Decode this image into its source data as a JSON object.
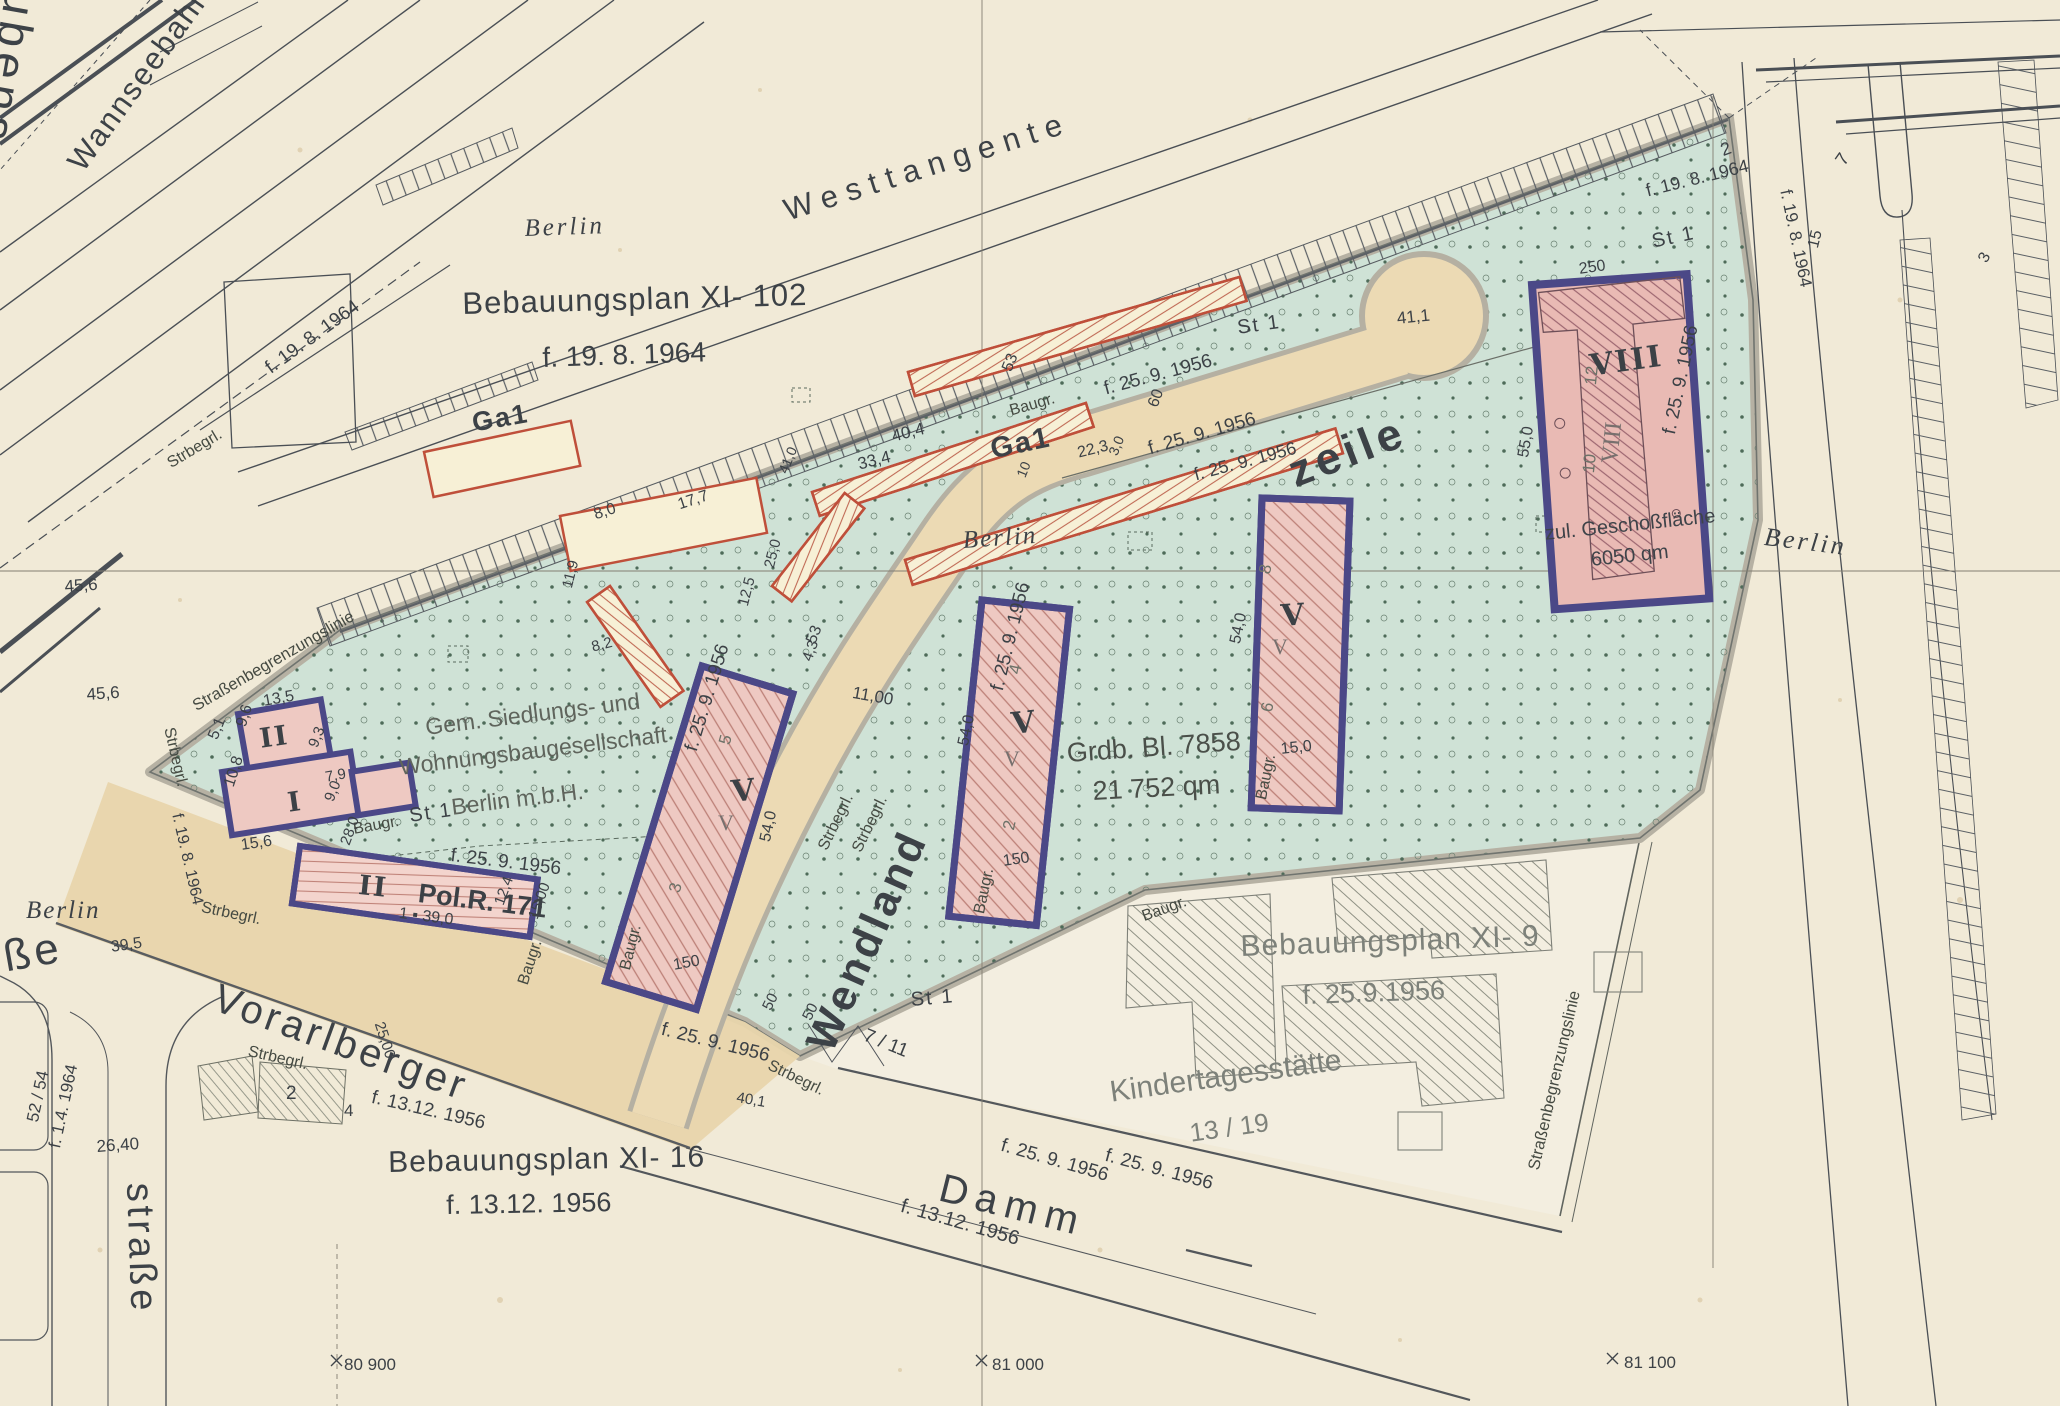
{
  "palette": {
    "paper": "#f1ead7",
    "site_green": "#cfe2d6",
    "street_beige": "#ecdab4",
    "building_pink": "#eec9c2",
    "building_outline": "#4b4887",
    "garage_red": "#bf4f3a",
    "ink": "#3c4146"
  },
  "streets": {
    "westtangente": "Westtangente",
    "wannseebahn": "Wannseebahn",
    "rubens": "ubens",
    "zeile": "zeile",
    "wendland": "Wendland",
    "vorarlberger": "Vorarlberger",
    "damm": "Damm",
    "strasse": "straße",
    "strasse_fragment": "ße"
  },
  "plans": {
    "xi102": {
      "title": "Bebauungsplan XI-  102",
      "date": "f. 19. 8. 1964"
    },
    "xi9": {
      "title": "Bebauungsplan XI- 9",
      "date": "f. 25.9.1956"
    },
    "xi16": {
      "title": "Bebauungsplan XI-  16",
      "date": "f. 13.12. 1956"
    }
  },
  "berlin": "Berlin",
  "owner": {
    "line1": "Gem. Siedlungs- und",
    "line2": "Wohnungsbaugesellschaft",
    "line3": "Berlin m.b.H."
  },
  "parcel": {
    "grundbuch": "Grdb. Bl. 7858",
    "area": "21 752 qm"
  },
  "kita": {
    "name": "Kindertagesstätte",
    "plot": "13 / 19"
  },
  "viii_note": {
    "line1": "zul. Geschoßfläche",
    "line2": "6050 qm"
  },
  "roman": {
    "i": "I",
    "ii": "II",
    "v": "V",
    "viii": "VIII"
  },
  "police": "Pol.R. 171",
  "garage": "Ga1",
  "misc": {
    "st1": "St 1",
    "baugr": "Baugr.",
    "strbegrl": "Strbegrl.",
    "grenzlinie": "Straßenbegrenzungslinie"
  },
  "dates": {
    "d25_9_1956": "f. 25. 9. 1956",
    "d19_8_1964": "f. 19. 8. 1964",
    "d13_12_1956": "f. 13.12. 1956",
    "d1_4_1964": "f. 1.4. 1964"
  },
  "coords": [
    "80 900",
    "81 000",
    "81 100"
  ],
  "dims": [
    "13,5",
    "9,6",
    "5,1",
    "9,3",
    "10,8",
    "7,9",
    "9,0",
    "15,6",
    "28,0",
    "1 ▪ 39,0",
    "12,4",
    "15,00",
    "54,0",
    "150",
    "5",
    "3",
    "4",
    "2",
    "54,0",
    "150",
    "8",
    "6",
    "54,0",
    "15,0",
    "12",
    "10",
    "250",
    "55,0",
    "41,1",
    "11,00",
    "50",
    "50",
    "40,1",
    "7 / 11",
    "53",
    "53",
    "60",
    "22,3",
    "3,0",
    "10",
    "40,4",
    "33,4",
    "8,0",
    "17,7",
    "11,9",
    "12,5",
    "25,0",
    "8,2",
    "4,3",
    "41,0",
    "45,6",
    "45,6",
    "39,5",
    "26,40",
    "25,00",
    "52 / 54",
    "2",
    "4",
    "2",
    "7",
    "15",
    "3"
  ]
}
